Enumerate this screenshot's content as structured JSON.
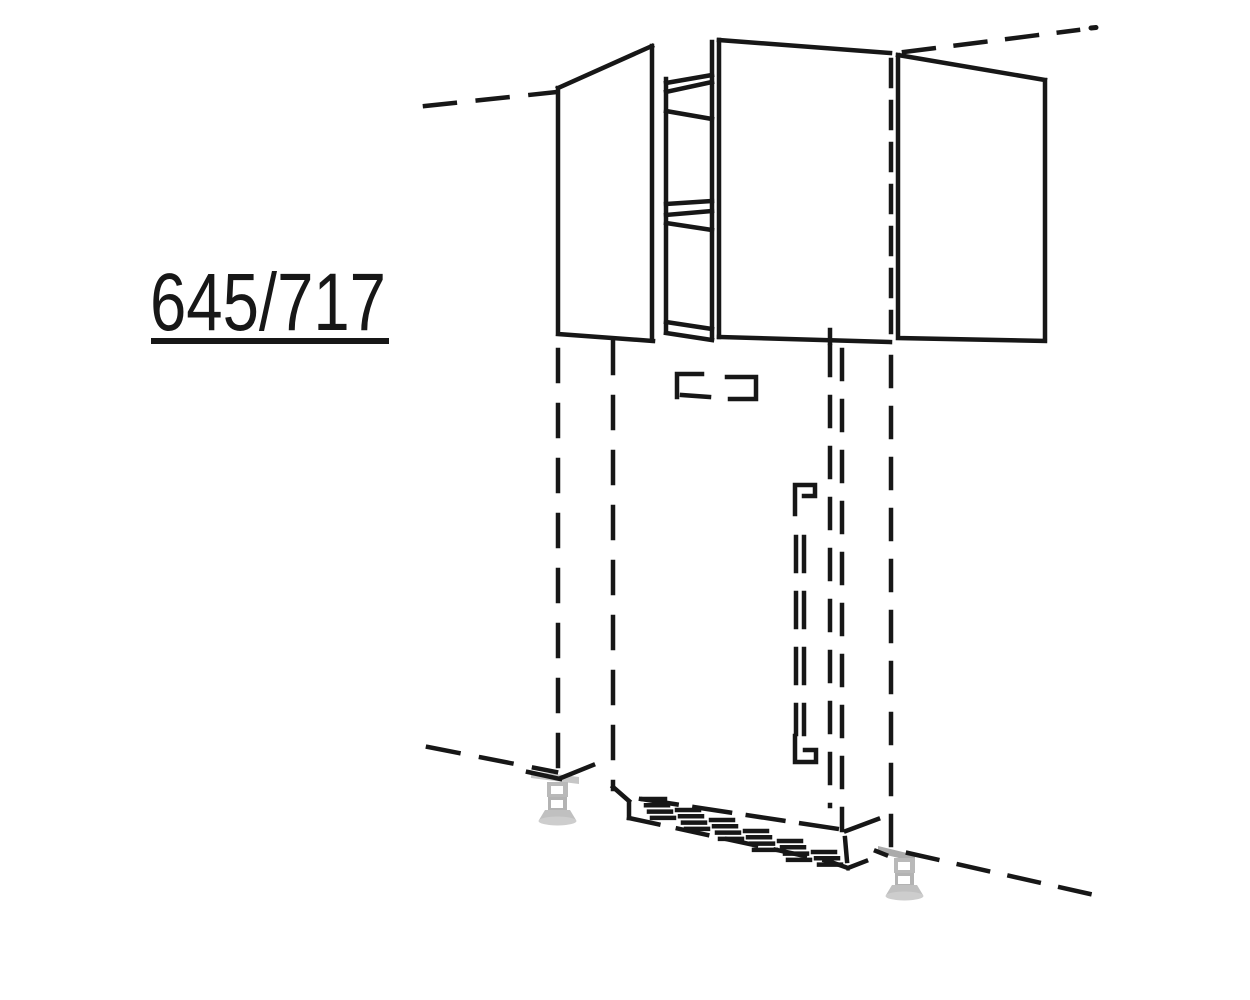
{
  "meta": {
    "width": 1250,
    "height": 1000,
    "background": "#ffffff"
  },
  "label": {
    "text": "645/717",
    "underlined": true
  },
  "colors": {
    "line": "#171717",
    "foot_gray": "#b9b9b9",
    "foot_gray_dark": "#ababab",
    "foot_gray_light": "#cdcdcd",
    "background": "#ffffff"
  },
  "diagram": {
    "type": "technical-line-drawing",
    "style": "kitchen catalog perspective drawing",
    "solid_parts": [
      "wall unit with left door, center door and right door",
      "open gap between left and center door showing shelf edges",
      "two wall-rail brackets below the unit bottom"
    ],
    "dashed_parts": [
      "vertical join line between center and right door",
      "niche outline below the unit",
      "vertical bar handle with top and bottom mounts",
      "ventilation hatch band above the plinth",
      "adjacent-unit continuation dashes top-left, top-right, bottom-left, bottom-right"
    ],
    "gray_parts": [
      "adjustable plinth foot left",
      "adjustable plinth foot right"
    ]
  }
}
